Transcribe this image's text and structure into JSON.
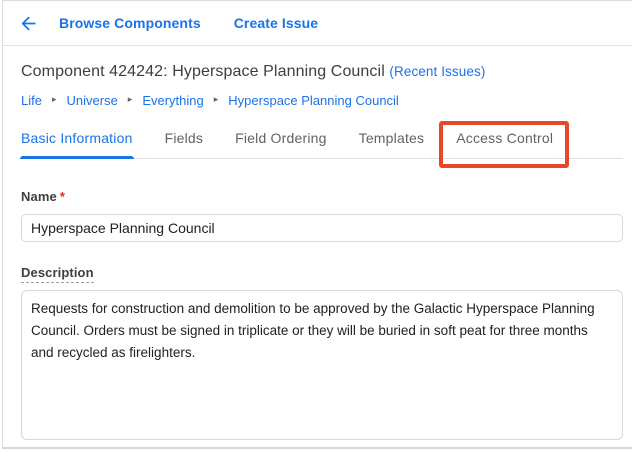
{
  "colors": {
    "accent": "#1a73e8",
    "highlight_box": "#e8482a",
    "required_marker": "#d93025"
  },
  "toolbar": {
    "back_icon": "arrow-back",
    "browse_components_label": "Browse Components",
    "create_issue_label": "Create Issue"
  },
  "header": {
    "title": "Component 424242: Hyperspace Planning Council",
    "recent_issues_label": "(Recent Issues)"
  },
  "breadcrumb": {
    "items": [
      "Life",
      "Universe",
      "Everything",
      "Hyperspace Planning Council"
    ],
    "separator": "▸"
  },
  "tabs": {
    "items": [
      {
        "label": "Basic Information",
        "active": true
      },
      {
        "label": "Fields",
        "active": false
      },
      {
        "label": "Field Ordering",
        "active": false
      },
      {
        "label": "Templates",
        "active": false
      },
      {
        "label": "Access Control",
        "active": false,
        "highlighted": true
      }
    ]
  },
  "form": {
    "name": {
      "label": "Name",
      "required_marker": "*",
      "value": "Hyperspace Planning Council"
    },
    "description": {
      "label": "Description",
      "value": "Requests for construction and demolition to be approved by the Galactic Hyperspace Planning Council. Orders must be signed in triplicate or they will be buried in soft peat for three months and recycled as firelighters."
    }
  }
}
